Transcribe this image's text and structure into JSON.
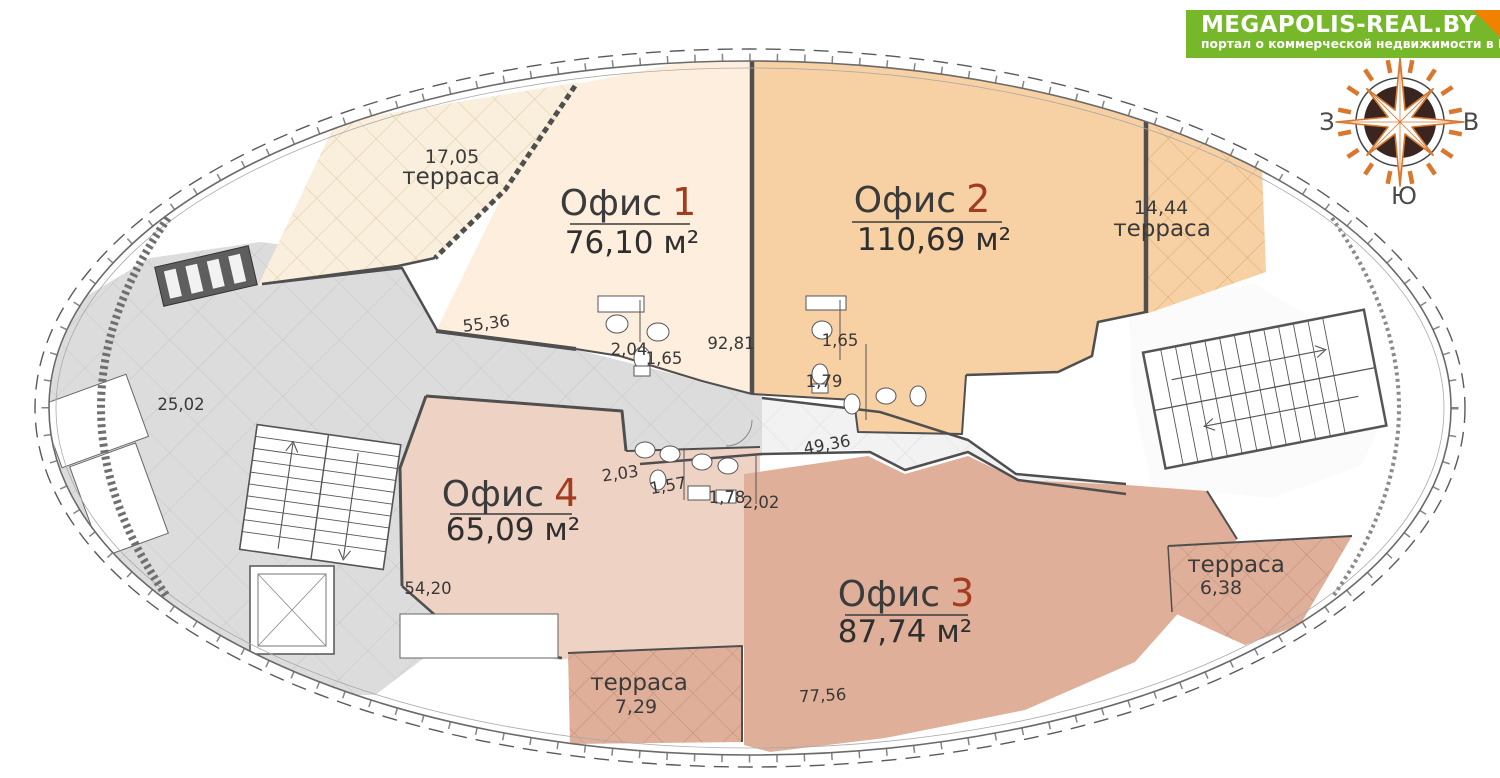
{
  "logo": {
    "title": "MEGAPOLIS-REAL.BY",
    "subtitle": "портал о коммерческой недвижимости в Беларуси"
  },
  "compass": {
    "west": "З",
    "east": "В",
    "south": "Ю"
  },
  "offices": {
    "o1": {
      "label": "Офис",
      "num": "1",
      "area": "76,10 м²"
    },
    "o2": {
      "label": "Офис",
      "num": "2",
      "area": "110,69 м²"
    },
    "o3": {
      "label": "Офис",
      "num": "3",
      "area": "87,74 м²"
    },
    "o4": {
      "label": "Офис",
      "num": "4",
      "area": "65,09 м²"
    }
  },
  "terraces": {
    "t17": {
      "num": "17,05",
      "label": "терраса"
    },
    "t14": {
      "num": "14,44",
      "label": "терраса"
    },
    "t6": {
      "label": "терраса",
      "num": "6,38"
    },
    "t7": {
      "label": "терраса",
      "num": "7,29"
    }
  },
  "dims": {
    "lobby": "25,02",
    "top_wall": "55,36",
    "o2_inner": "92,81",
    "wc1_a": "2,04",
    "wc1_b": "1,65",
    "wc2_a": "1,65",
    "wc2_b": "1,79",
    "corridor": "49,36",
    "wc3_a": "2,03",
    "wc3_b": "1,57",
    "wc3_c": "1,78",
    "wc3_d": "2,02",
    "o4_inner": "54,20",
    "o3_inner": "77,56"
  },
  "colors": {
    "office1": "#fdeedd",
    "office2": "#f7d0a3",
    "office3": "#e0af99",
    "office4": "#eed3c4",
    "terrace_cream": "#f9efdc",
    "terrace_peach": "#f7d0a3",
    "terrace_rose": "#e0af99",
    "common_gray": "#dcdcdc",
    "corridor_light": "#f2f2f2",
    "number_red": "#a23b20",
    "logo_green": "#76b82a",
    "logo_corner": "#f08200",
    "compass_orange": "#d9782d",
    "compass_dark": "#3a2521"
  }
}
